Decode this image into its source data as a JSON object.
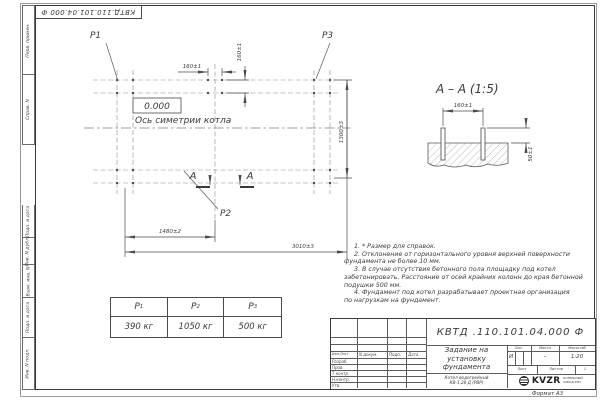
{
  "colors": {
    "ink": "#3a3a3a",
    "paper": "#ffffff"
  },
  "sheet": {
    "doc_number_vertical": "КВТД.110.101.04.000 Ф",
    "format_label": "Формат А3"
  },
  "left_strip": {
    "cells": [
      "Перв. примен.",
      "Справ. N",
      "",
      "Подп. и дата",
      "Инв. N дубл.",
      "Взам. инв. N",
      "Подп. и дата",
      "Инв. N подл."
    ]
  },
  "plan": {
    "point_labels": {
      "p1": "P1",
      "p2": "P2",
      "p3": "P3"
    },
    "zero_level": "0.000",
    "axis_caption": "Ось симетрии котла",
    "section_letter": "А",
    "dims": {
      "bolt_pitch_x": "160±1",
      "bolt_pitch_y": "160±1",
      "half_length": "1480±2",
      "length": "3010±3",
      "width": "1300±3"
    }
  },
  "section": {
    "title": "А – А (1:5)",
    "dims": {
      "bolt_pitch": "160±1",
      "bolt_protrusion": "50±1"
    }
  },
  "notes": {
    "lines": [
      "1. * Размер для справок.",
      "2. Отклонение от горизонтального уровня верхней поверхности",
      "фундамента не более 10 мм.",
      "3. В случае отсутствия бетонного пола площадку под котел",
      "забетонировать. Расстояние от осей крайних колонн до края бетонной",
      "подушки 500 мм.",
      "4. Фундамент под котел разрабатывает проектная организация",
      "по нагрузкам на фундамент."
    ]
  },
  "load_table": {
    "columns": [
      {
        "symbol": "P",
        "sub": "1",
        "value": "390 кг"
      },
      {
        "symbol": "P",
        "sub": "2",
        "value": "1050 кг"
      },
      {
        "symbol": "P",
        "sub": "3",
        "value": "500 кг"
      }
    ]
  },
  "title_block": {
    "doc_number": "КВТД .110.101.04.000  Ф",
    "header_cells": [
      "Изм.Лист",
      "N докум.",
      "Подп.",
      "Дата"
    ],
    "sign_rows": [
      "Разраб.",
      "Пров.",
      "Т.контр.",
      "Н.контр.",
      "Утв."
    ],
    "title_lines": [
      "Задание на",
      "установку",
      "фундамента"
    ],
    "product_lines": [
      "Котел водогрейный",
      "КВ-1,28 Д (РВР)"
    ],
    "lit_label": "Лит.",
    "mass_label": "Масса",
    "scale_label": "Масштаб",
    "lit_value": "И",
    "mass_value": "–",
    "scale_value": "1:20",
    "sheet_label": "Лист",
    "sheets_label": "Листов",
    "sheets_value": "1",
    "logo_text": "KVZR",
    "logo_icon": "striped-globe",
    "logo_subtext_lines": [
      "КОТЕЛЬНЫЙ",
      "ЗАВОД РЭП"
    ]
  }
}
